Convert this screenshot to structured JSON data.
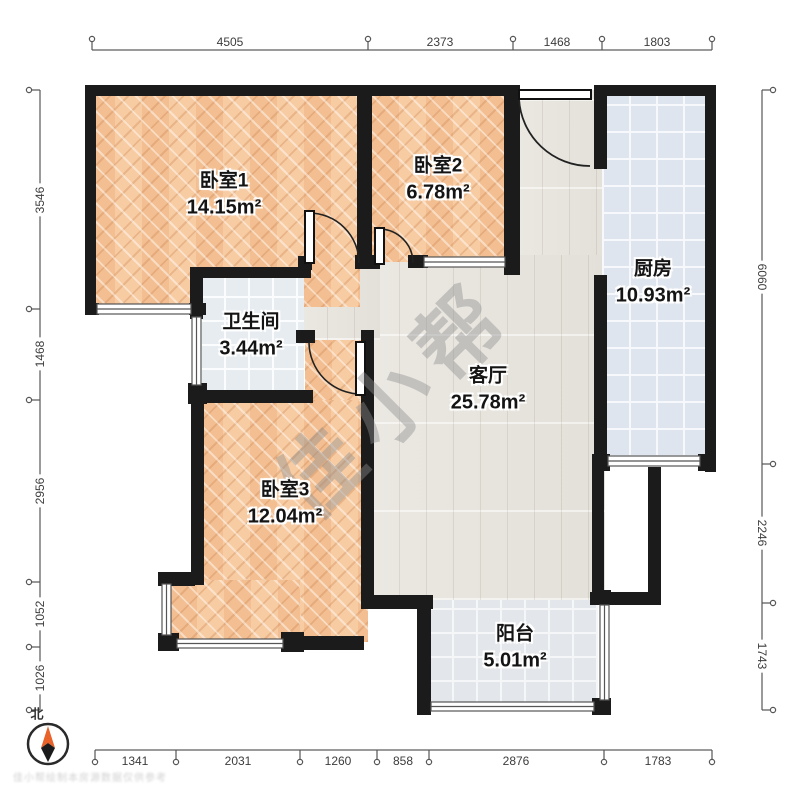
{
  "plan": {
    "watermark": "佳小帮",
    "compass_label": "北",
    "footer_watermark": "佳小帮绘制本房源数据仅供参考"
  },
  "rooms": {
    "bedroom1": {
      "name": "卧室1",
      "area": "14.15m²"
    },
    "bedroom2": {
      "name": "卧室2",
      "area": "6.78m²"
    },
    "kitchen": {
      "name": "厨房",
      "area": "10.93m²"
    },
    "bathroom": {
      "name": "卫生间",
      "area": "3.44m²"
    },
    "living": {
      "name": "客厅",
      "area": "25.78m²"
    },
    "bedroom3": {
      "name": "卧室3",
      "area": "12.04m²"
    },
    "balcony": {
      "name": "阳台",
      "area": "5.01m²"
    }
  },
  "dimensions": {
    "top": [
      "4505",
      "2373",
      "1468",
      "1803"
    ],
    "bottom": [
      "1341",
      "2031",
      "1260",
      "858",
      "2876",
      "1783"
    ],
    "left": [
      "3546",
      "1468",
      "2956",
      "1052",
      "1026"
    ],
    "right": [
      "6060",
      "2246",
      "1743"
    ]
  },
  "colors": {
    "wall": "#1b1b1b",
    "bedroom_floor": "#f6c89e",
    "living_floor": "#e9e6e0",
    "kitchen_floor": "#dfe5ee",
    "balcony_floor": "#e3e6ea",
    "compass_needle": "#e8622a",
    "dimension_line": "#9a9a9a"
  }
}
